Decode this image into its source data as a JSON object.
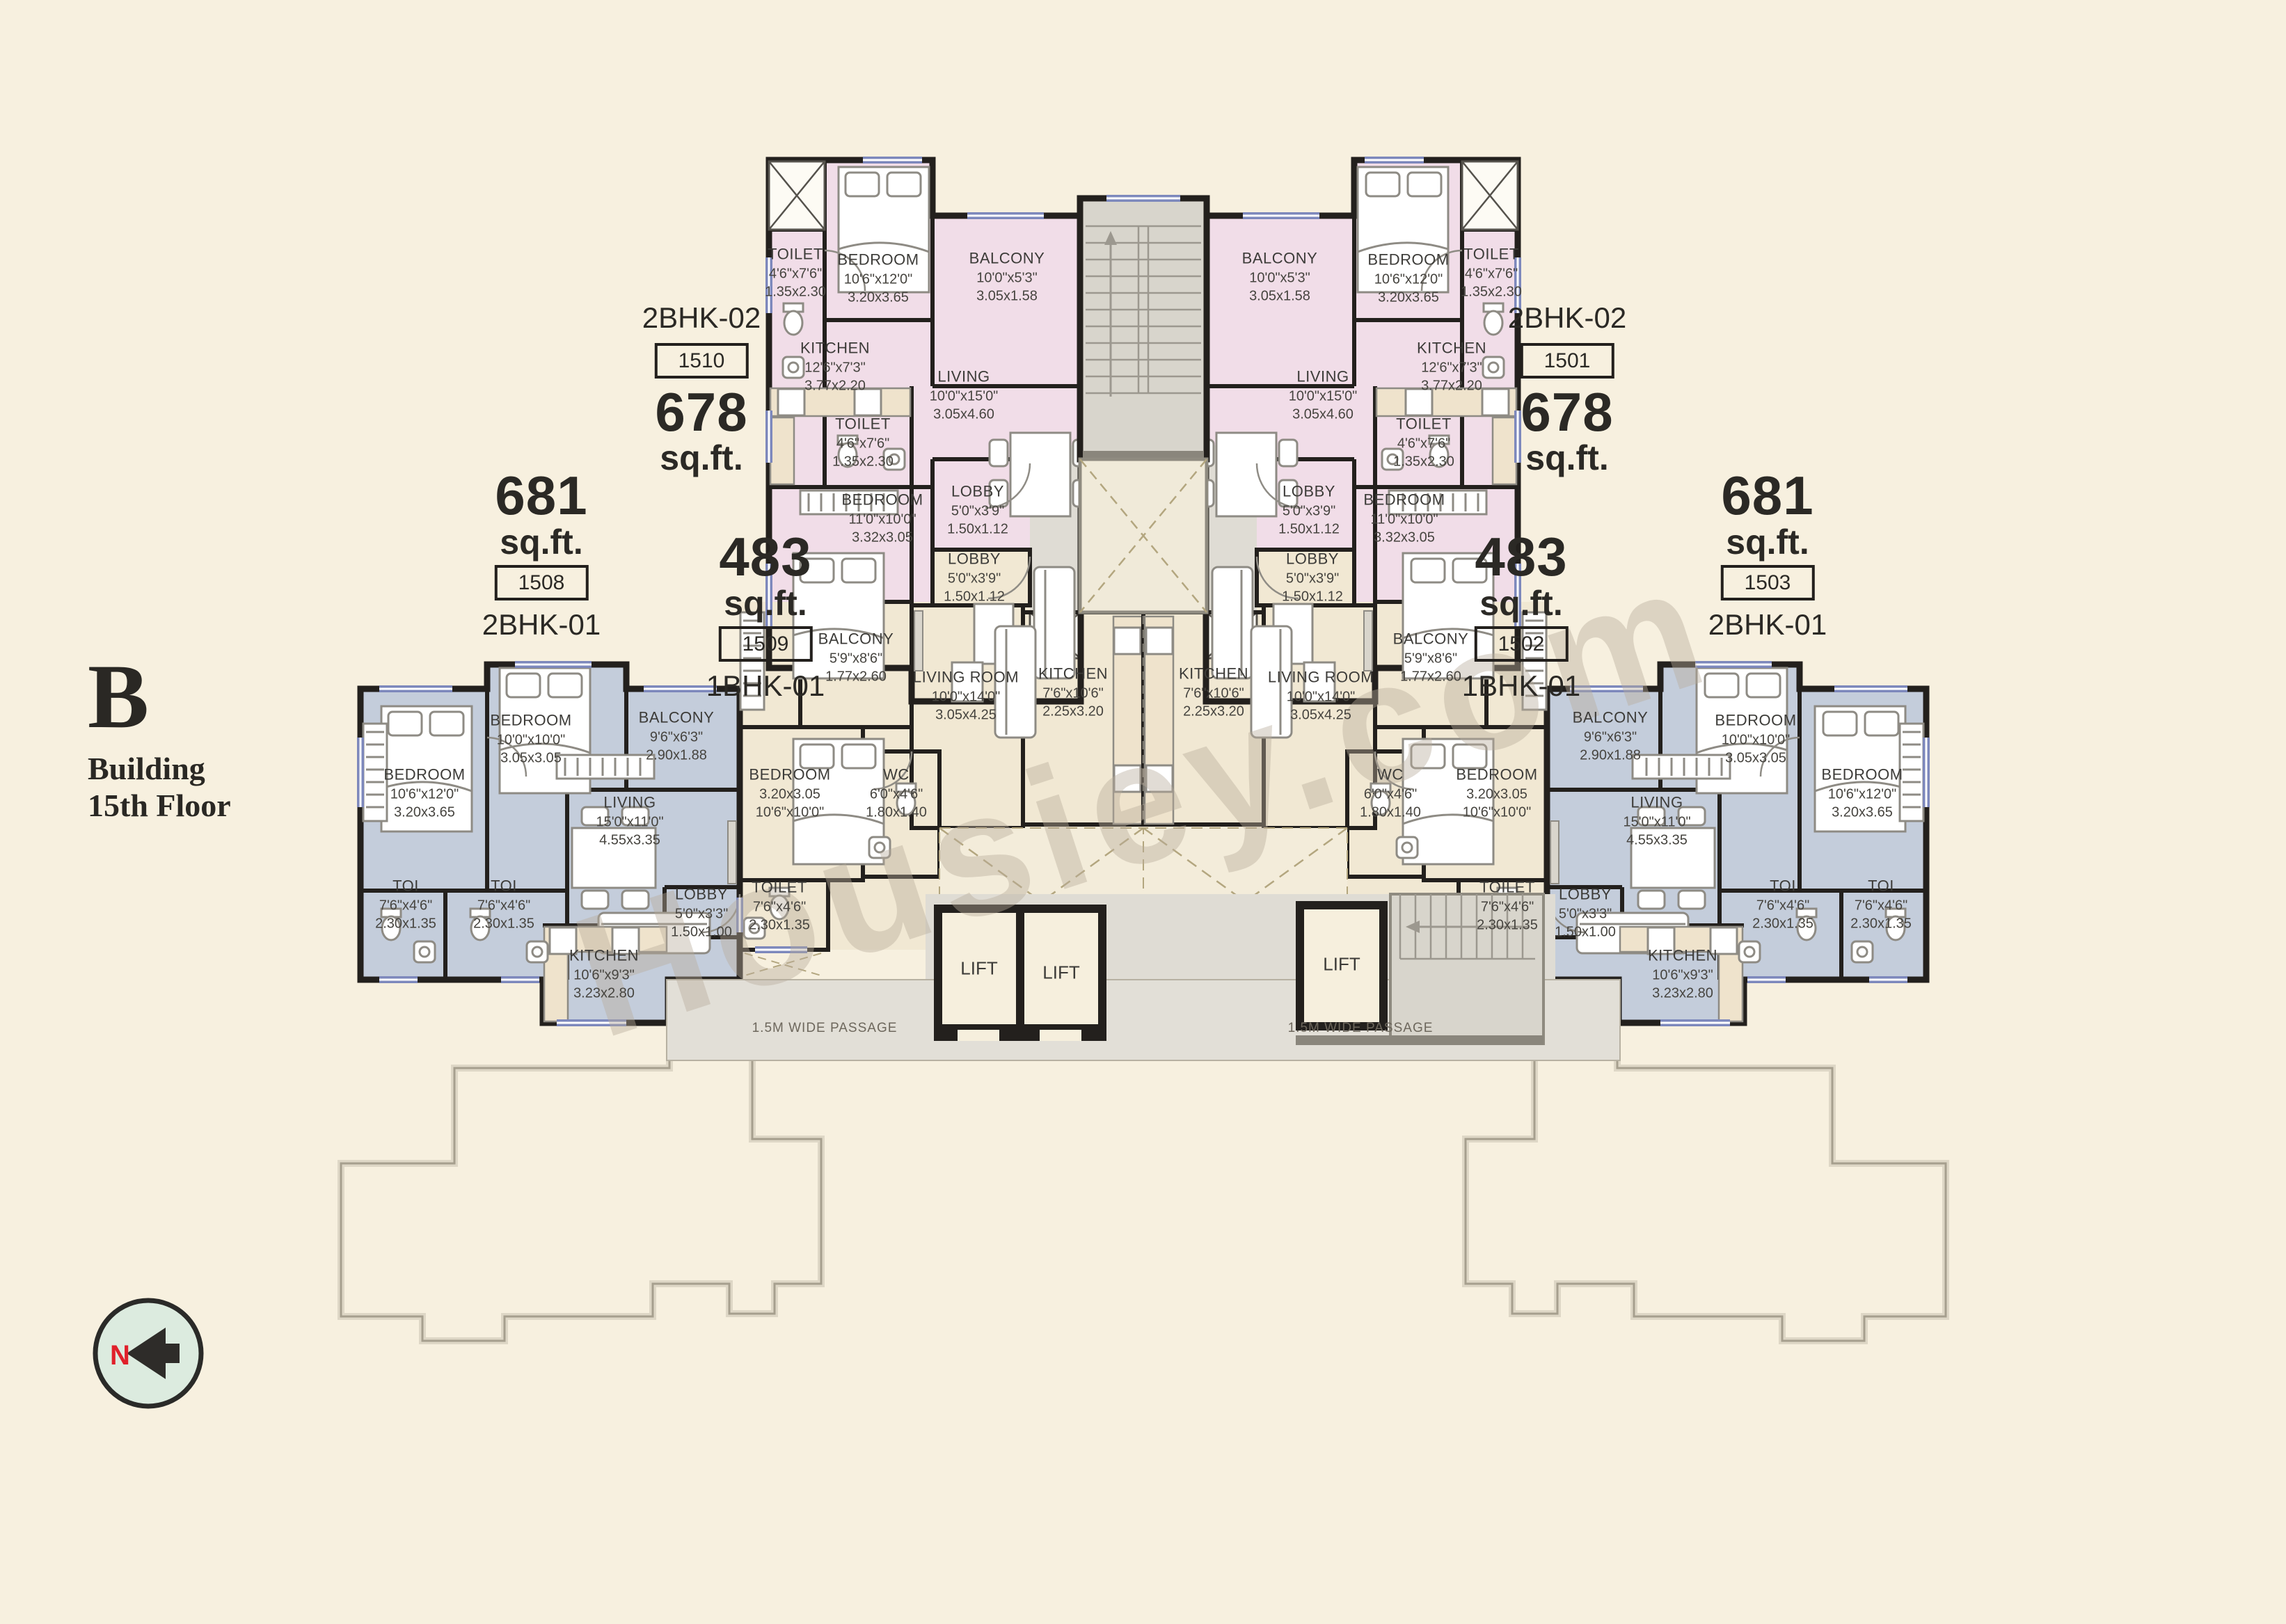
{
  "meta": {
    "building_letter": "B",
    "building_line1": "Building",
    "building_line2": "15th Floor",
    "north_letter": "N",
    "watermark": "Housiey.com",
    "passage_label": "1.5M WIDE PASSAGE",
    "lift_label": "LIFT"
  },
  "area_blocks": [
    {
      "id": "1510",
      "type": "2BHK-02",
      "area": "678",
      "area_unit": "sq.ft."
    },
    {
      "id": "1501",
      "type": "2BHK-02",
      "area": "678",
      "area_unit": "sq.ft."
    },
    {
      "id": "1508",
      "type": "2BHK-01",
      "area": "681",
      "area_unit": "sq.ft."
    },
    {
      "id": "1503",
      "type": "2BHK-01",
      "area": "681",
      "area_unit": "sq.ft."
    },
    {
      "id": "1509",
      "type": "1BHK-01",
      "area": "483",
      "area_unit": "sq.ft."
    },
    {
      "id": "1502",
      "type": "1BHK-01",
      "area": "483",
      "area_unit": "sq.ft."
    }
  ],
  "units": {
    "u1510": {
      "rooms": [
        {
          "name": "TOILET",
          "d1": "4'6\"x7'6\"",
          "d2": "1.35x2.30"
        },
        {
          "name": "BEDROOM",
          "d1": "10'6\"x12'0\"",
          "d2": "3.20x3.65"
        },
        {
          "name": "BALCONY",
          "d1": "10'0\"x5'3\"",
          "d2": "3.05x1.58"
        },
        {
          "name": "KITCHEN",
          "d1": "12'6\"x7'3\"",
          "d2": "3.77x2.20"
        },
        {
          "name": "LIVING",
          "d1": "10'0\"x15'0\"",
          "d2": "3.05x4.60"
        },
        {
          "name": "TOILET",
          "d1": "4'6\"x7'6\"",
          "d2": "1.35x2.30"
        },
        {
          "name": "BEDROOM",
          "d1": "11'0\"x10'0\"",
          "d2": "3.32x3.05"
        },
        {
          "name": "LOBBY",
          "d1": "5'0\"x3'9\"",
          "d2": "1.50x1.12"
        }
      ]
    },
    "u1501": {
      "rooms": [
        {
          "name": "TOILET",
          "d1": "4'6\"x7'6\"",
          "d2": "1.35x2.30"
        },
        {
          "name": "BEDROOM",
          "d1": "10'6\"x12'0\"",
          "d2": "3.20x3.65"
        },
        {
          "name": "BALCONY",
          "d1": "10'0\"x5'3\"",
          "d2": "3.05x1.58"
        },
        {
          "name": "KITCHEN",
          "d1": "12'6\"x7'3\"",
          "d2": "3.77x2.20"
        },
        {
          "name": "LIVING",
          "d1": "10'0\"x15'0\"",
          "d2": "3.05x4.60"
        },
        {
          "name": "TOILET",
          "d1": "4'6\"x7'6\"",
          "d2": "1.35x2.30"
        },
        {
          "name": "BEDROOM",
          "d1": "11'0\"x10'0\"",
          "d2": "3.32x3.05"
        },
        {
          "name": "LOBBY",
          "d1": "5'0\"x3'9\"",
          "d2": "1.50x1.12"
        }
      ]
    },
    "u1509": {
      "rooms": [
        {
          "name": "LOBBY",
          "d1": "5'0\"x3'9\"",
          "d2": "1.50x1.12"
        },
        {
          "name": "BALCONY",
          "d1": "5'9\"x8'6\"",
          "d2": "1.77x2.60"
        },
        {
          "name": "LIVING ROOM",
          "d1": "10'0\"x14'0\"",
          "d2": "3.05x4.25"
        },
        {
          "name": "KITCHEN",
          "d1": "7'6\"x10'6\"",
          "d2": "2.25x3.20"
        },
        {
          "name": "BEDROOM",
          "d1": "3.20x3.05",
          "d2": "10'6\"x10'0\""
        },
        {
          "name": "WC",
          "d1": "6'0\"x4'6\"",
          "d2": "1.80x1.40"
        },
        {
          "name": "TOILET",
          "d1": "7'6\"x4'6\"",
          "d2": "2.30x1.35"
        }
      ]
    },
    "u1502": {
      "rooms": [
        {
          "name": "LOBBY",
          "d1": "5'0\"x3'9\"",
          "d2": "1.50x1.12"
        },
        {
          "name": "BALCONY",
          "d1": "5'9\"x8'6\"",
          "d2": "1.77x2.60"
        },
        {
          "name": "LIVING ROOM",
          "d1": "10'0\"x14'0\"",
          "d2": "3.05x4.25"
        },
        {
          "name": "KITCHEN",
          "d1": "7'6\"x10'6\"",
          "d2": "2.25x3.20"
        },
        {
          "name": "BEDROOM",
          "d1": "3.20x3.05",
          "d2": "10'6\"x10'0\""
        },
        {
          "name": "WC",
          "d1": "6'0\"x4'6\"",
          "d2": "1.80x1.40"
        },
        {
          "name": "TOILET",
          "d1": "7'6\"x4'6\"",
          "d2": "2.30x1.35"
        }
      ]
    },
    "u1508": {
      "rooms": [
        {
          "name": "BEDROOM",
          "d1": "10'6\"x12'0\"",
          "d2": "3.20x3.65"
        },
        {
          "name": "BEDROOM",
          "d1": "10'0\"x10'0\"",
          "d2": "3.05x3.05"
        },
        {
          "name": "BALCONY",
          "d1": "9'6\"x6'3\"",
          "d2": "2.90x1.88"
        },
        {
          "name": "LIVING",
          "d1": "15'0\"x11'0\"",
          "d2": "4.55x3.35"
        },
        {
          "name": "TOI",
          "d1": "7'6\"x4'6\"",
          "d2": "2.30x1.35"
        },
        {
          "name": "TOI",
          "d1": "7'6\"x4'6\"",
          "d2": "2.30x1.35"
        },
        {
          "name": "LOBBY",
          "d1": "5'0\"x3'3\"",
          "d2": "1.50x1.00"
        },
        {
          "name": "KITCHEN",
          "d1": "10'6\"x9'3\"",
          "d2": "3.23x2.80"
        }
      ]
    },
    "u1503": {
      "rooms": [
        {
          "name": "BEDROOM",
          "d1": "10'6\"x12'0\"",
          "d2": "3.20x3.65"
        },
        {
          "name": "BEDROOM",
          "d1": "10'0\"x10'0\"",
          "d2": "3.05x3.05"
        },
        {
          "name": "BALCONY",
          "d1": "9'6\"x6'3\"",
          "d2": "2.90x1.88"
        },
        {
          "name": "LIVING",
          "d1": "15'0\"x11'0\"",
          "d2": "4.55x3.35"
        },
        {
          "name": "TOI",
          "d1": "7'6\"x4'6\"",
          "d2": "2.30x1.35"
        },
        {
          "name": "TOI",
          "d1": "7'6\"x4'6\"",
          "d2": "2.30x1.35"
        },
        {
          "name": "LOBBY",
          "d1": "5'0\"x3'3\"",
          "d2": "1.50x1.00"
        },
        {
          "name": "KITCHEN",
          "d1": "10'6\"x9'3\"",
          "d2": "3.23x2.80"
        }
      ]
    },
    "colors": {
      "background": "#f7f0df",
      "unit_2bhk02": "#f1dde8",
      "unit_2bhk01": "#c4cddb",
      "unit_1bhk01": "#f1e8d3",
      "circulation": "#dfdcd4",
      "wall": "#23201d",
      "window": "#7d88bc",
      "outline": "#a69f8e",
      "north_red": "#e0202a"
    }
  }
}
